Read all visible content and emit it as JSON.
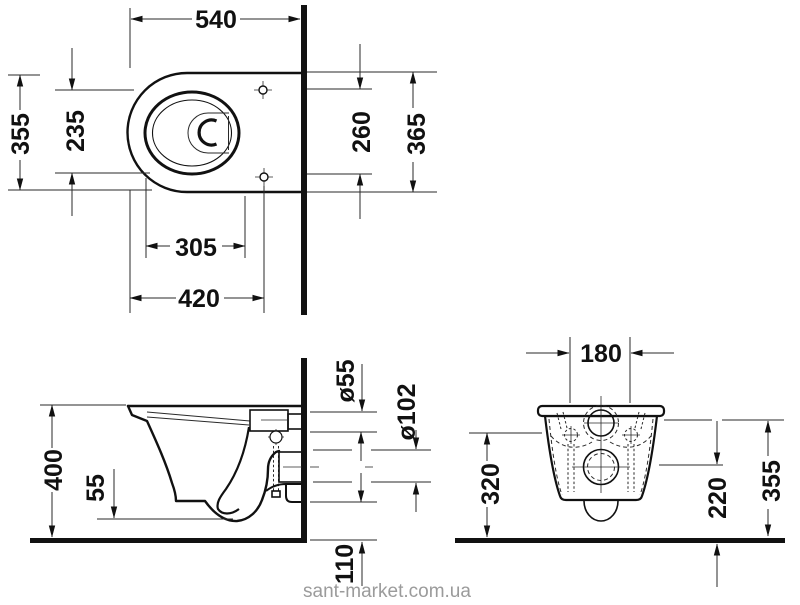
{
  "watermark": "sant-market.com.ua",
  "views": {
    "top": {
      "dims": {
        "d540": "540",
        "d355": "355",
        "d235": "235",
        "d260": "260",
        "d365": "365",
        "d305": "305",
        "d420": "420"
      }
    },
    "side": {
      "dims": {
        "d400": "400",
        "d55": "55",
        "dia55": "ø55",
        "dia102": "ø102",
        "d110": "110"
      }
    },
    "front": {
      "dims": {
        "d180": "180",
        "d320": "320",
        "d220": "220",
        "d355": "355"
      }
    }
  }
}
